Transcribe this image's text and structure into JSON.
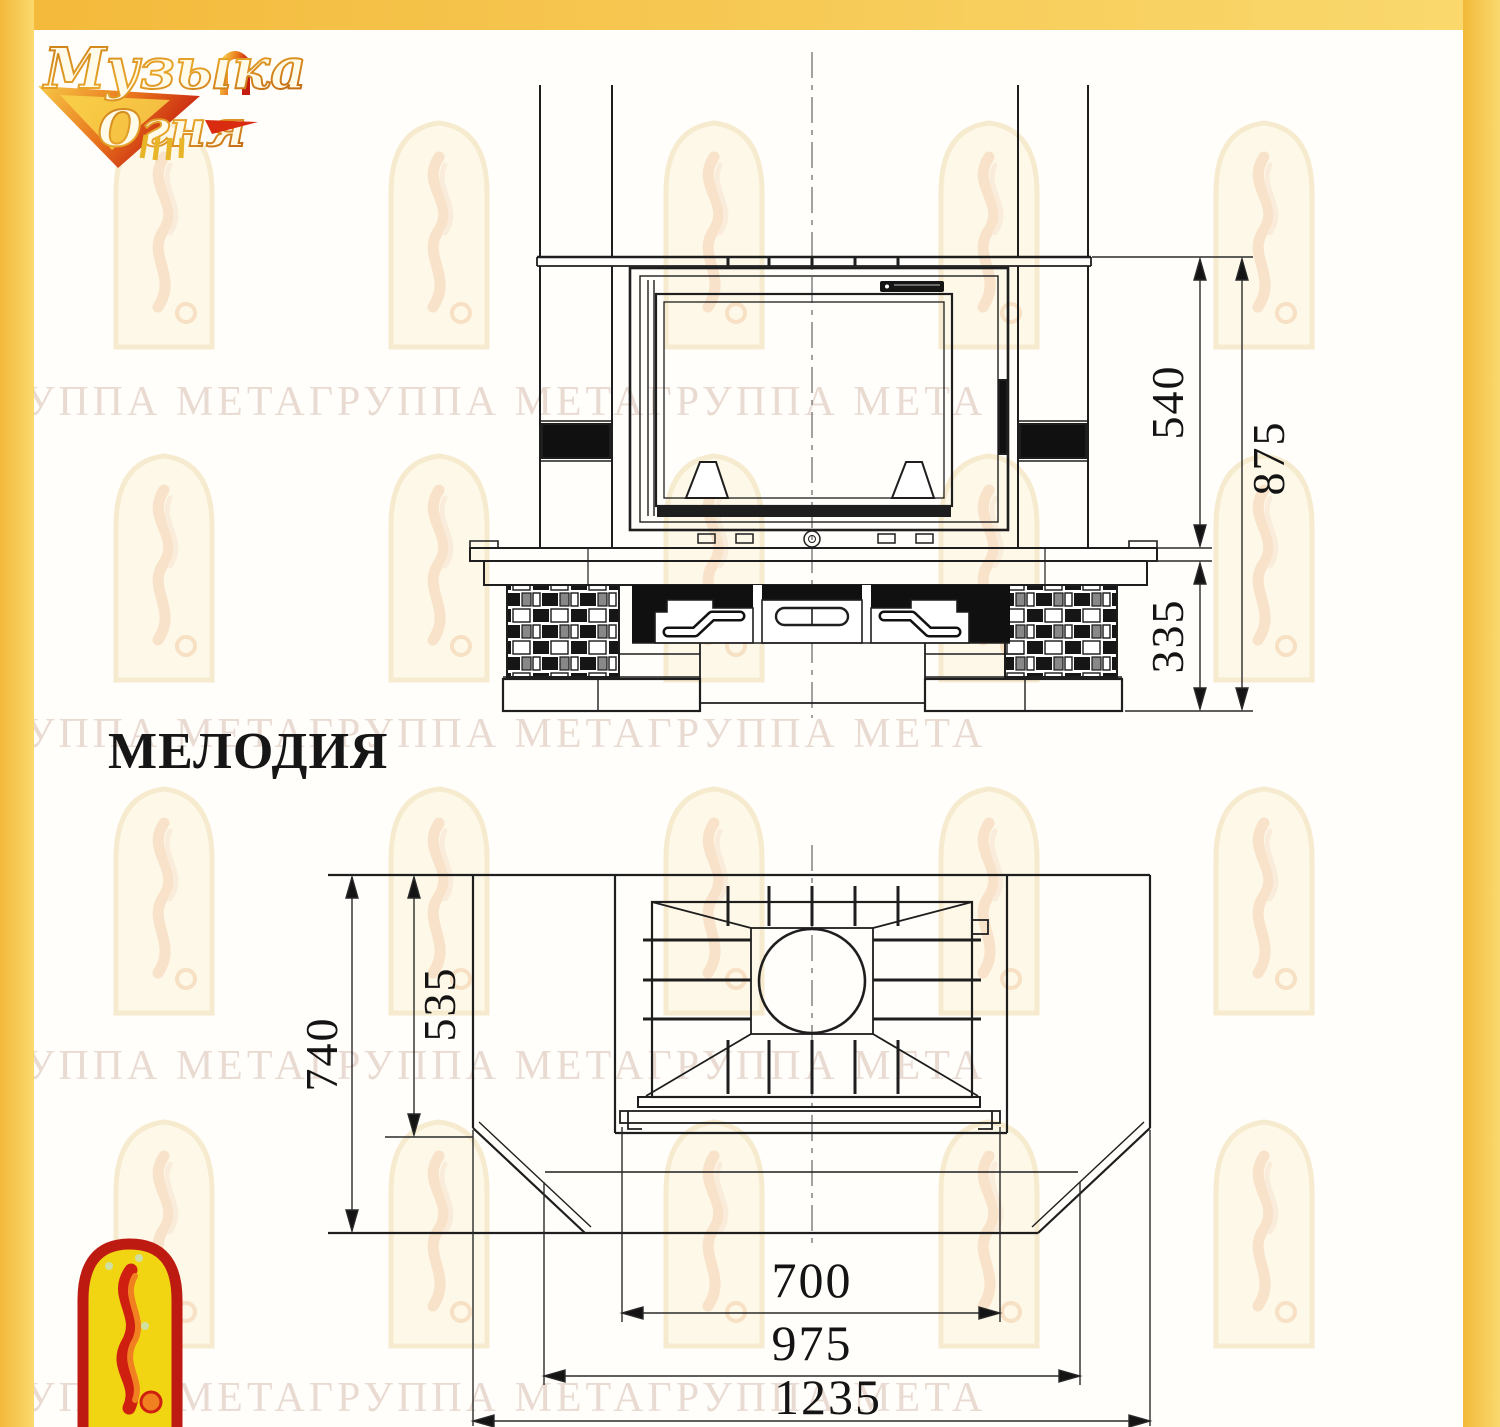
{
  "page": {
    "title_model": "МЕЛОДИЯ",
    "accent_border_color": "#f6c64b",
    "line_color": "#1e1e1e"
  },
  "brand_logo": {
    "word1": "Музыка",
    "word2": "Огня"
  },
  "watermark": {
    "row": "ГРУППА МЕТАГРУППА МЕТАГРУППА МЕТА"
  },
  "drawing": {
    "front_view": {
      "dim_firebox_height": "540",
      "dim_total_height": "875",
      "dim_base_height": "335"
    },
    "plan_view": {
      "dim_depth_total": "740",
      "dim_depth_firebox": "535",
      "dim_width_opening": "700",
      "dim_width_hearth": "975",
      "dim_width_total": "1235"
    }
  }
}
